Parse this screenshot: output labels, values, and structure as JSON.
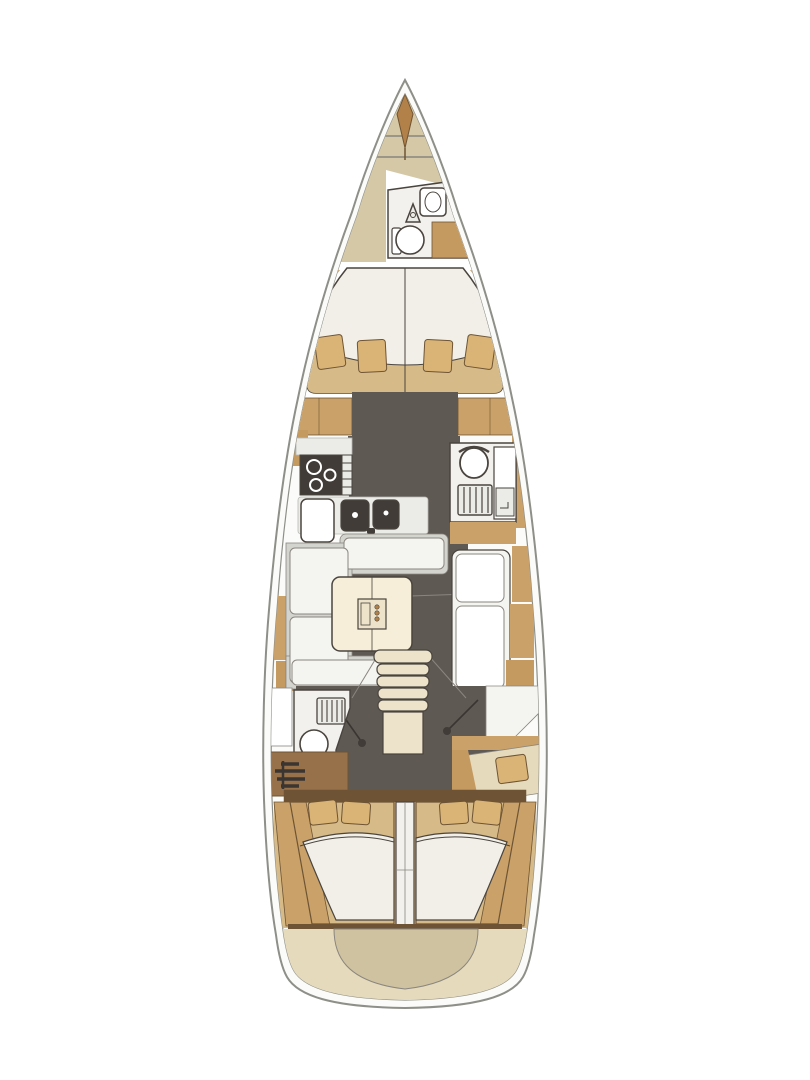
{
  "diagram": {
    "kind": "sailing-yacht-interior-deck-plan",
    "orientation": "bow-up",
    "areas": [
      {
        "id": "bow-anchor-locker",
        "fixtures": [
          "anchor"
        ]
      },
      {
        "id": "forward-head",
        "fixtures": [
          "washbasin",
          "faucet",
          "toilet",
          "counter"
        ]
      },
      {
        "id": "forward-cabin",
        "fixtures": [
          "double-v-berth",
          "pillows-x4",
          "port-locker",
          "starboard-locker"
        ]
      },
      {
        "id": "galley",
        "fixtures": [
          "worktop",
          "stove-3-burner",
          "gimbal-rail",
          "fridge",
          "double-sink"
        ]
      },
      {
        "id": "mid-head",
        "fixtures": [
          "toilet",
          "shower-grate",
          "washbasin-counter"
        ]
      },
      {
        "id": "salon",
        "fixtures": [
          "u-settee",
          "saloon-table",
          "bottle-holder",
          "straight-settee"
        ]
      },
      {
        "id": "companionway",
        "fixtures": [
          "stairs-5-treads",
          "landing",
          "port-door",
          "starboard-door"
        ]
      },
      {
        "id": "aft-head",
        "fixtures": [
          "vanity-panel",
          "shower-grate",
          "toilet",
          "engine-cabinet"
        ]
      },
      {
        "id": "aft-cabin-port",
        "fixtures": [
          "double-berth",
          "pillows-x2"
        ]
      },
      {
        "id": "aft-cabin-starboard",
        "fixtures": [
          "double-berth",
          "pillows-x2"
        ]
      },
      {
        "id": "stern",
        "fixtures": [
          "transom-platform",
          "lazarette"
        ]
      }
    ]
  },
  "colors": {
    "page_bg": "#ffffff",
    "hull_outline": "#8f8f89",
    "hull_fill": "#fbfbf9",
    "deck_khaki": "#d5c8a6",
    "deck_tan": "#c9a169",
    "deck_tan_dark": "#c49a60",
    "wood_brown": "#96714a",
    "wood_dark": "#6e5434",
    "floor_dark": "#5f5954",
    "room_white": "#f2f1ed",
    "fixture_white": "#ffffff",
    "counter_light": "#ebebe7",
    "settee_gray": "#d4d4cf",
    "cushion_white": "#f4f4f1",
    "table_cream": "#f6eed8",
    "step_cream": "#ece3ca",
    "mattress_white": "#f1efe8",
    "bed_tan": "#d6ba88",
    "pillow_tan": "#d9b476",
    "stern_beige": "#e5dabc",
    "stern_inner": "#cfc2a0",
    "appliance_dark": "#413c37",
    "anchor_brown": "#b28049",
    "outline_dark": "#4a443e",
    "outline_mid": "#8a867f",
    "outline_light": "#b8b8b4",
    "door_dark": "#3a3531",
    "burner_ring": "#ffffff"
  }
}
